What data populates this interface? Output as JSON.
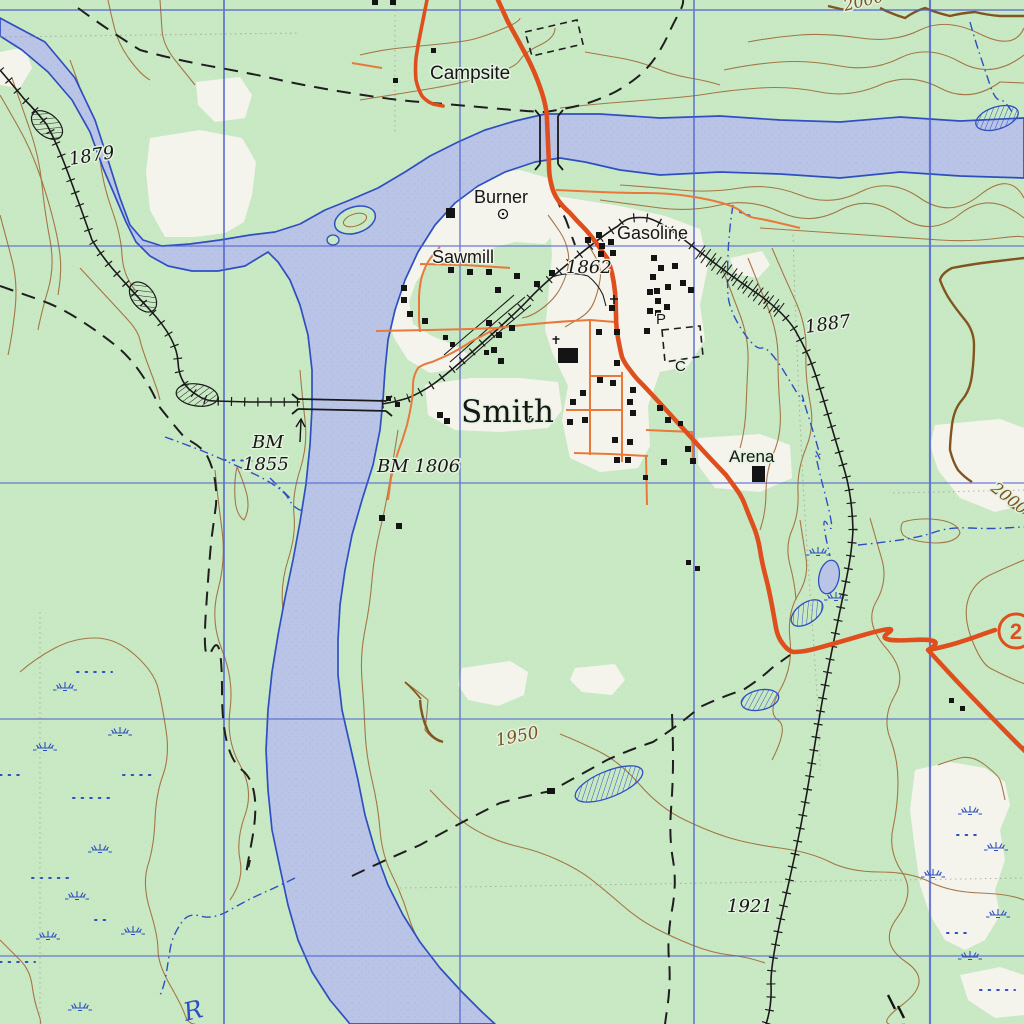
{
  "map": {
    "type": "usgs-style topographic map",
    "place_labels": {
      "campsite": "Campsite",
      "burner": "Burner",
      "sawmill": "Sawmill",
      "gasoline": "Gasoline",
      "town": "Smith",
      "arena": "Arena",
      "post_office_letter": "P",
      "cemetery_letter": "C",
      "river_initial": "R"
    },
    "benchmarks": {
      "bm_west_line1": "BM",
      "bm_west_line2": "1855",
      "bm_east": "BM 1806"
    },
    "elevations": {
      "spot_1879": "1879",
      "spot_1862": "1862",
      "spot_1887": "1887",
      "spot_1921": "1921",
      "contour_1950": "1950",
      "contour_2000_top": "2000",
      "contour_2000_right": "2000"
    },
    "route_shield": {
      "number": "2"
    },
    "colors": {
      "woodland_green": "#c9e9c4",
      "clearing_white": "#f5f4ec",
      "water_fill": "#b9c3e6",
      "water_edge": "#2f4fc1",
      "grid_blue": "#4a5ecf",
      "contour_brown": "#a06a38",
      "index_contour_brown": "#82541f",
      "highway_orange": "#df4f1e",
      "minor_road_orange": "#e87a3c",
      "railroad_black": "#1a1a1a",
      "label_black": "#161616"
    },
    "symbols": [
      "railroad-track",
      "railroad-bridge",
      "road-bridge",
      "buildings",
      "church-cross",
      "school-cross",
      "well-symbol",
      "benchmark-arrow",
      "marsh-tufts",
      "intermittent-ponds",
      "intermittent-streams",
      "cut-fill-hatching",
      "cemetery-plot",
      "corral-plot",
      "trail-dashes"
    ]
  }
}
